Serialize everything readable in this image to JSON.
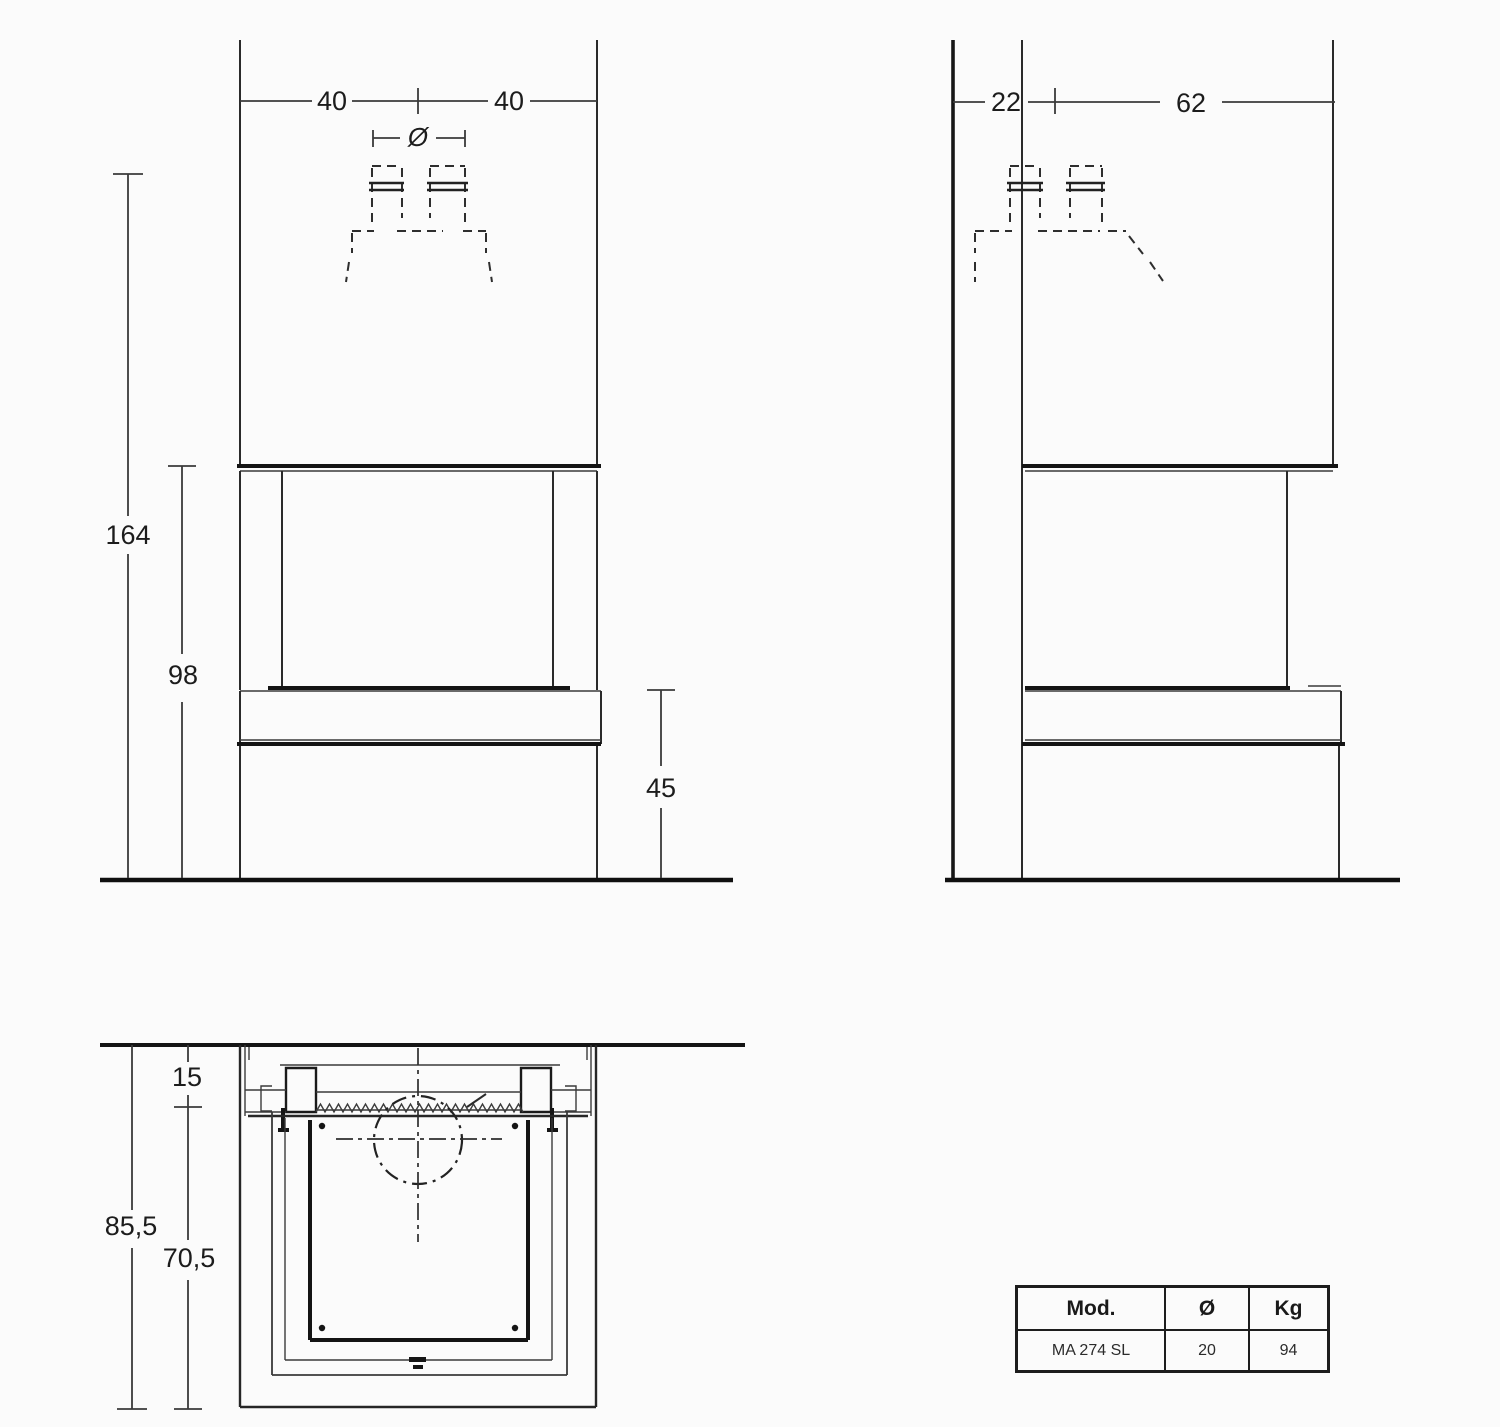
{
  "dimensions": {
    "front_width_left": "40",
    "front_width_right": "40",
    "flue_diameter_symbol": "Ø",
    "front_total_height": "164",
    "front_firebox_height": "98",
    "front_bench_height": "45",
    "side_back_offset": "22",
    "side_depth": "62",
    "plan_wall_clearance": "15",
    "plan_total_depth": "85,5",
    "plan_inner_depth": "70,5"
  },
  "table": {
    "headers": {
      "model": "Mod.",
      "diameter": "Ø",
      "weight": "Kg"
    },
    "rows": [
      {
        "model": "MA 274 SL",
        "diameter": "20",
        "weight": "94"
      }
    ]
  },
  "colors": {
    "line": "#2a2a2a",
    "thick_line": "#141414",
    "background": "#fbfbfb"
  }
}
